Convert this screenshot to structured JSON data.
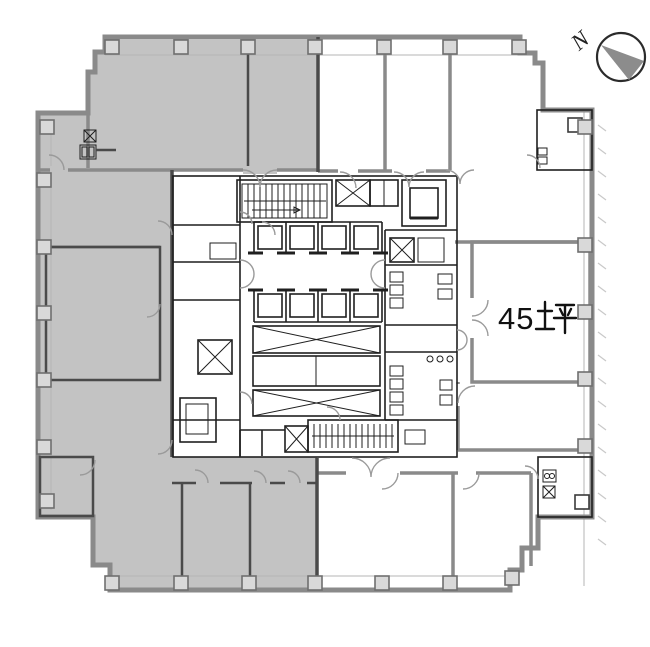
{
  "page": {
    "background": "#ffffff"
  },
  "floor_plan": {
    "compass": {
      "letter": "N"
    },
    "area_label": {
      "value": "45",
      "unit_char": "坪",
      "full": "45坪"
    },
    "areas": [
      {
        "id": "northwest",
        "shaded": true
      },
      {
        "id": "west",
        "shaded": true
      },
      {
        "id": "southwest",
        "shaded": true
      },
      {
        "id": "south-center",
        "shaded": true
      },
      {
        "id": "north-center",
        "shaded": false
      },
      {
        "id": "northeast",
        "shaded": false
      },
      {
        "id": "east",
        "shaded": false,
        "label": "45坪"
      },
      {
        "id": "southeast",
        "shaded": false
      }
    ],
    "colors": {
      "shaded_area_fill": "#c3c3c3",
      "outer_wall": "#8a8a8a",
      "partition_wall": "#4a4a4a",
      "core_line": "#1f1f1f",
      "door_arc": "#9a9a9a",
      "column_fill": "#d9d9d9",
      "compass_wedge": "#8c8c8c",
      "label_text": "#111111"
    }
  }
}
